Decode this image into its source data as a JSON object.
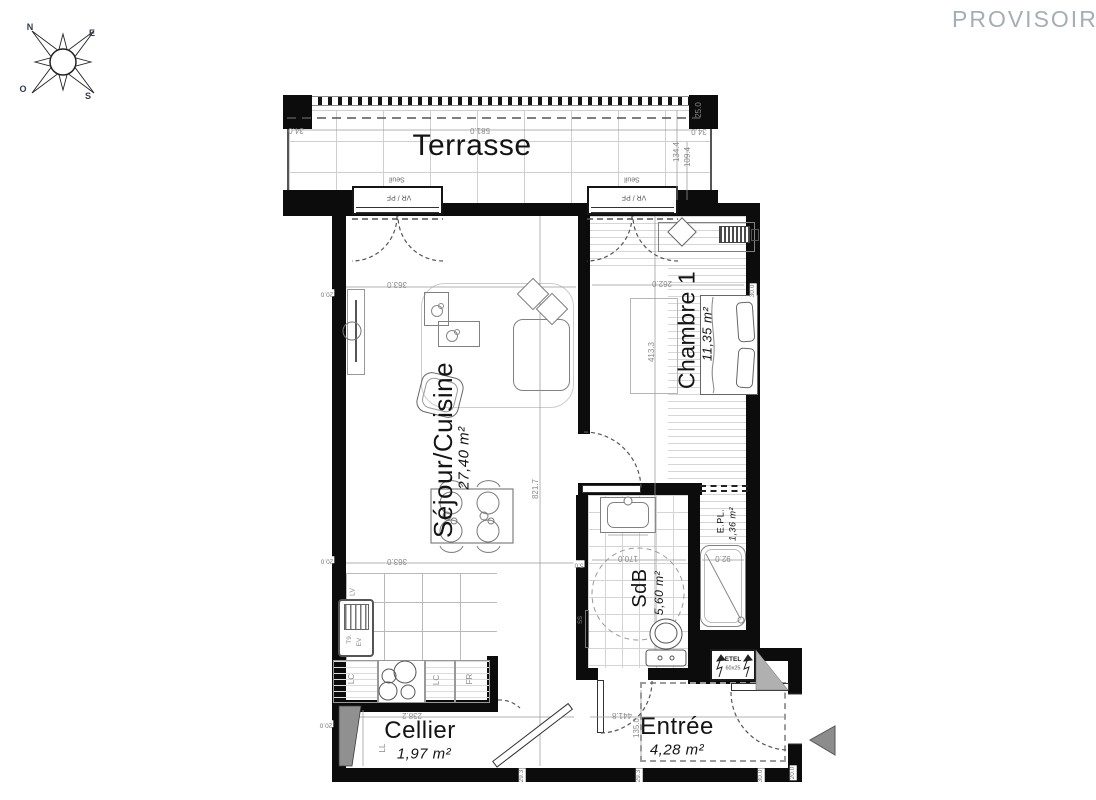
{
  "watermark": "PROVISOIRE",
  "compass": {
    "north": "N",
    "east": "E",
    "west": "O",
    "south": "S"
  },
  "rooms": {
    "terrasse": {
      "name": "Terrasse"
    },
    "sejour": {
      "name": "Séjour/Cuisine",
      "area": "27,40 m²"
    },
    "chambre": {
      "name": "Chambre 1",
      "area": "11,35 m²"
    },
    "sdb": {
      "name": "SdB",
      "area": "5,60 m²"
    },
    "epl": {
      "name": "E.PL.",
      "area": "1,36 m²"
    },
    "cellier": {
      "name": "Cellier",
      "area": "1,97 m²"
    },
    "entree": {
      "name": "Entrée",
      "area": "4,28 m²"
    }
  },
  "openings": {
    "seuil": "Seuil",
    "vr_pf": "VR / PF"
  },
  "equipment": {
    "lv": "LV",
    "t9": "T9.",
    "ev": "EV",
    "lc": "LC",
    "fr": "FR",
    "ll": "LL",
    "ss": "SS",
    "etel": "ETEL",
    "etel_size": "60x25"
  },
  "dims": {
    "d581": "581.0",
    "d34": "34.0",
    "d25": "25.0",
    "d134": "134.4",
    "d109": "109.4",
    "d363": "363.0",
    "d821": "821.7",
    "d20": "20.0",
    "d262": "262.0",
    "d413": "413.3",
    "d30": "30.0",
    "d170": "170.0",
    "d92": "92.0",
    "d5": "5.0",
    "d238": "238.2",
    "d441": "441.8",
    "d135": "135.0",
    "d29": "29.3"
  },
  "colors": {
    "wall": "#0c0c0c",
    "dim_text": "#8a8a8a",
    "watermark": "#a6adb6",
    "arrow": "#8c8c8c"
  }
}
